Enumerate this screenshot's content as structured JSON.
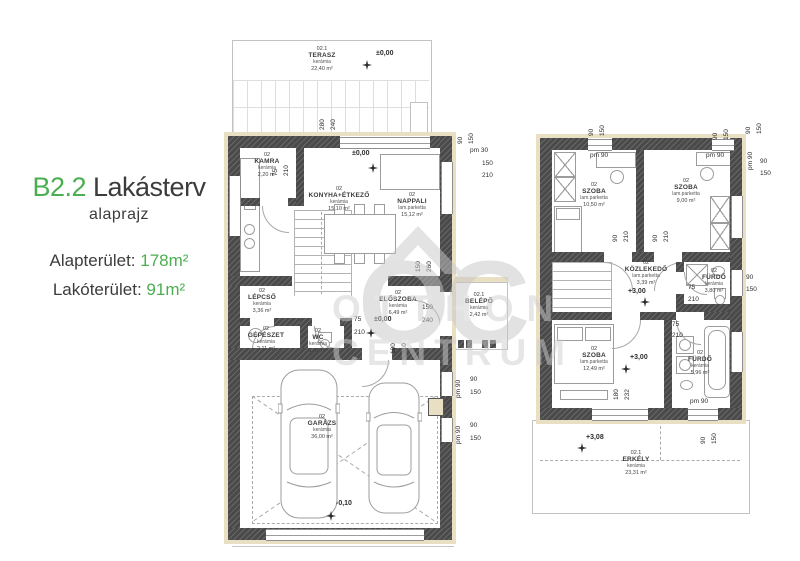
{
  "panel": {
    "code": "B2.2",
    "title": "Lakásterv",
    "subtitle": "alaprajz",
    "area_total_label": "Alapterület:",
    "area_total_value": "178m²",
    "area_living_label": "Lakóterület:",
    "area_living_value": "91m²",
    "accent_color": "#4bae50"
  },
  "watermark": {
    "initials": "OC",
    "line1": "OTTHON",
    "line2": "CENTRUM"
  },
  "gf": {
    "rooms": {
      "terasz": {
        "id": "02.1",
        "name": "TERASZ",
        "mat": "kerámia",
        "area": "22,40 m²",
        "level": "±0,00"
      },
      "kamra": {
        "id": "02",
        "name": "KAMRA",
        "mat": "kerámia",
        "area": "2,20 m²"
      },
      "konyha": {
        "id": "02",
        "name": "KONYHA+ÉTKEZŐ",
        "mat": "kerámia",
        "area": "15,10 m²"
      },
      "nappali": {
        "id": "02",
        "name": "NAPPALI",
        "mat": "lam.parketta",
        "area": "15,12 m²",
        "level": "±0,00"
      },
      "lepcso": {
        "id": "02",
        "name": "LÉPCSŐ",
        "mat": "kerámia",
        "area": "3,36 m²"
      },
      "eloszoba": {
        "id": "02",
        "name": "ELŐSZOBA",
        "mat": "kerámia",
        "area": "6,49 m²",
        "level": "±0,00"
      },
      "gepeszet": {
        "id": "02",
        "name": "GÉPÉSZET",
        "mat": "kerámia",
        "area": "2,11 m²"
      },
      "wc": {
        "id": "02",
        "name": "WC",
        "mat": "kerámia",
        "area": "1,26 m²"
      },
      "belepo": {
        "id": "02.1",
        "name": "BELÉPŐ",
        "mat": "kerámia",
        "area": "2,42 m²"
      },
      "garazs": {
        "id": "02",
        "name": "GARÁZS",
        "mat": "kerámia",
        "area": "36,00 m²",
        "level": "-0,10"
      }
    },
    "dims": {
      "ter1": "280",
      "ter2": "240",
      "tr_a": "90",
      "tr_b": "150",
      "tr_pm": "pm 30",
      "tr_c": "150",
      "tr_d": "210",
      "kam_a": "75",
      "kam_b": "210",
      "elo_v1": "150",
      "elo_v2": "260",
      "wc_a": "75",
      "wc_b": "210",
      "elo_a": "100",
      "elo_b": "210",
      "bel_a": "150",
      "bel_b": "240",
      "g1_pm": "pm 90",
      "g1_a": "90",
      "g1_b": "150",
      "g2_pm": "pm 90",
      "g2_a": "90",
      "g2_b": "150"
    }
  },
  "uf": {
    "rooms": {
      "szoba1": {
        "id": "02",
        "name": "SZOBA",
        "mat": "lam.parketta",
        "area": "10,50 m²"
      },
      "szoba2": {
        "id": "02",
        "name": "SZOBA",
        "mat": "lam.parketta",
        "area": "9,00 m²"
      },
      "kozlekedo": {
        "id": "02",
        "name": "KÖZLEKEDŐ",
        "mat": "lam.parketta",
        "area": "3,39 m²",
        "level": "+3,00"
      },
      "furdo1": {
        "id": "02",
        "name": "FÜRDŐ",
        "mat": "kerámia",
        "area": "3,80 m²"
      },
      "szoba3": {
        "id": "02",
        "name": "SZOBA",
        "mat": "lam.parketta",
        "area": "12,49 m²",
        "level": "+3,00"
      },
      "furdo2": {
        "id": "02",
        "name": "FÜRDŐ",
        "mat": "kerámia",
        "area": "5,96 m²"
      },
      "erkely": {
        "id": "02.1",
        "name": "ERKÉLY",
        "mat": "kerámia",
        "area": "23,31 m²",
        "level": "+3,08"
      }
    },
    "dims": {
      "t1_a": "90",
      "t1_b": "150",
      "t1_pm": "pm 90",
      "t2_a": "90",
      "t2_b": "150",
      "t2_pm": "pm 90",
      "tr_v1": "90",
      "tr_v2": "150",
      "tr_pm": "pm 90",
      "tr_c": "90",
      "tr_d": "150",
      "d1_a": "90",
      "d1_b": "210",
      "d2_a": "90",
      "d2_b": "210",
      "f1_a": "75",
      "f1_b": "210",
      "f2_a": "75",
      "f2_b": "210",
      "w_a": "90",
      "w_b": "150",
      "v_a": "180",
      "v_b": "232",
      "br_pm": "pm 90",
      "br_a": "90",
      "br_b": "150"
    }
  }
}
